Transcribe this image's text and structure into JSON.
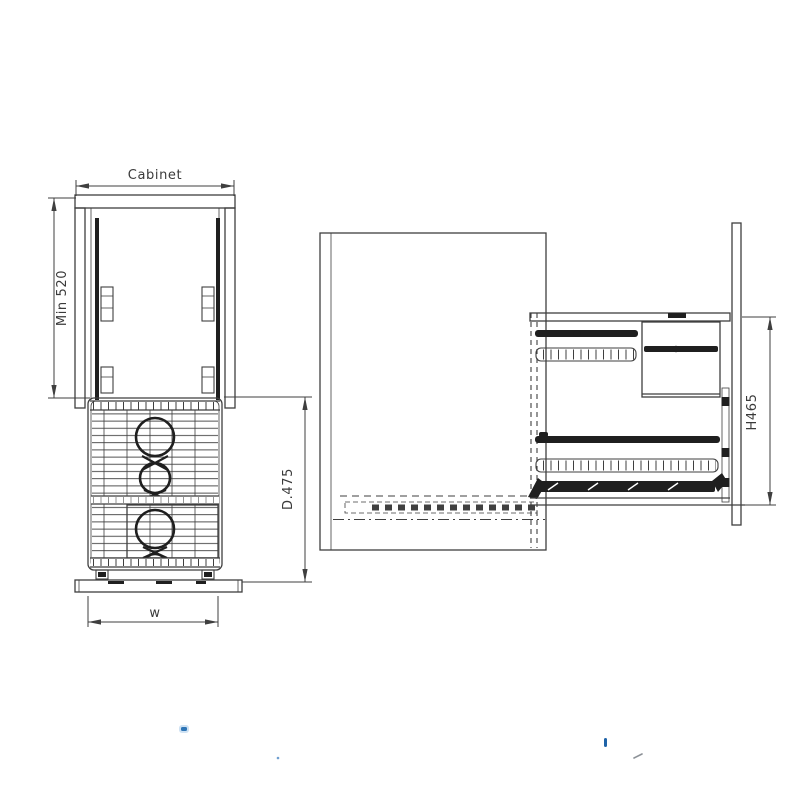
{
  "page": {
    "background": "#ffffff"
  },
  "colors": {
    "paper": "#ffffff",
    "line": "#3f3f3f",
    "dark": "#1f1f1f",
    "dim_text": "#3a3a3a",
    "blue_accent": "#2e75b6",
    "blue_deep": "#1f63a8",
    "blue_light": "#cfe2f3",
    "blue_soft": "#6f9fd0",
    "gray_mark": "#8d9298"
  },
  "front_view": {
    "labels": {
      "cabinet_width": "Cabinet",
      "min_height": "Min 520",
      "depth": "D.475",
      "width": "w"
    }
  },
  "side_view": {
    "labels": {
      "height": "H465"
    }
  }
}
